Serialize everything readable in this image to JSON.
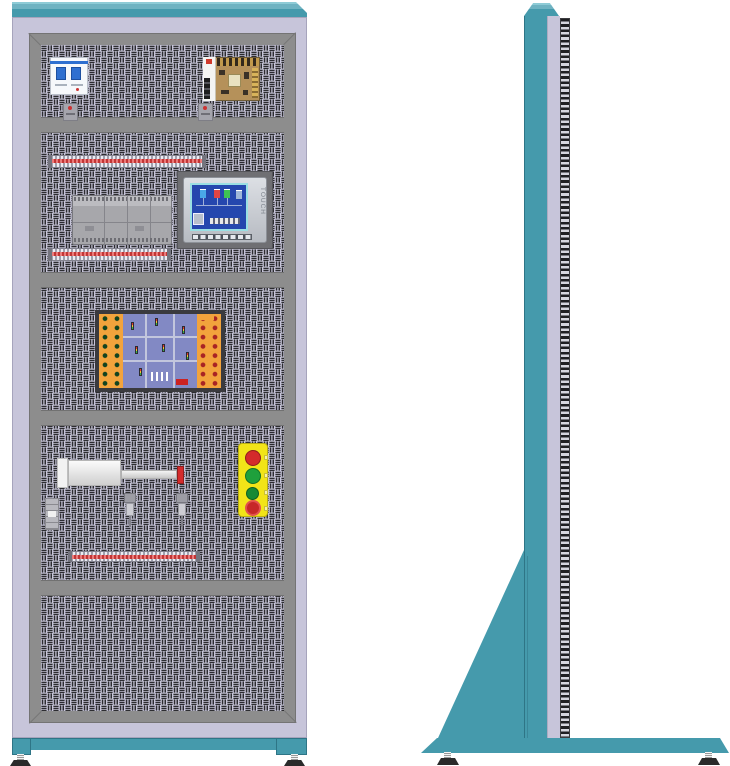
{
  "illustration": {
    "subject": "electrical-automation-training-cabinet",
    "views": {
      "left": "front",
      "right": "side"
    }
  },
  "hmi": {
    "touch_label": "TOUCH"
  },
  "components": {
    "front": [
      "circuit-breaker",
      "terminal-block",
      "switching-power-supply",
      "terminal-block",
      "din-terminal-rail",
      "plc-module",
      "hmi-touch-panel",
      "din-terminal-rail",
      "traffic-light-training-board",
      "pneumatic-cylinder",
      "mini-valve",
      "proximity-sensor",
      "proximity-sensor",
      "push-button-station",
      "emergency-stop-button",
      "din-terminal-rail"
    ],
    "side": [
      "cabinet-column",
      "perforated-edge",
      "support-gusset",
      "base-plate",
      "leveling-feet"
    ]
  },
  "colors": {
    "teal": "#459aac",
    "teal_highlight": "#8ecbd6",
    "lavender": "#c7c5da",
    "frame_gray": "#8d8d8d",
    "pattern_mark": "#2c2c30",
    "rail_red": "#c23535",
    "psu_pcb": "#b5915a",
    "board_orange": "#f2a33c",
    "board_blue": "#8289c4",
    "jack_green": "#12431f",
    "jack_red": "#a82424",
    "button_yellow": "#f2e418",
    "button_red": "#d42b2b",
    "button_green": "#1fa03c",
    "estop_red": "#c62828",
    "screen_blue": "#2547ae",
    "screen_border": "#9adfe3"
  }
}
